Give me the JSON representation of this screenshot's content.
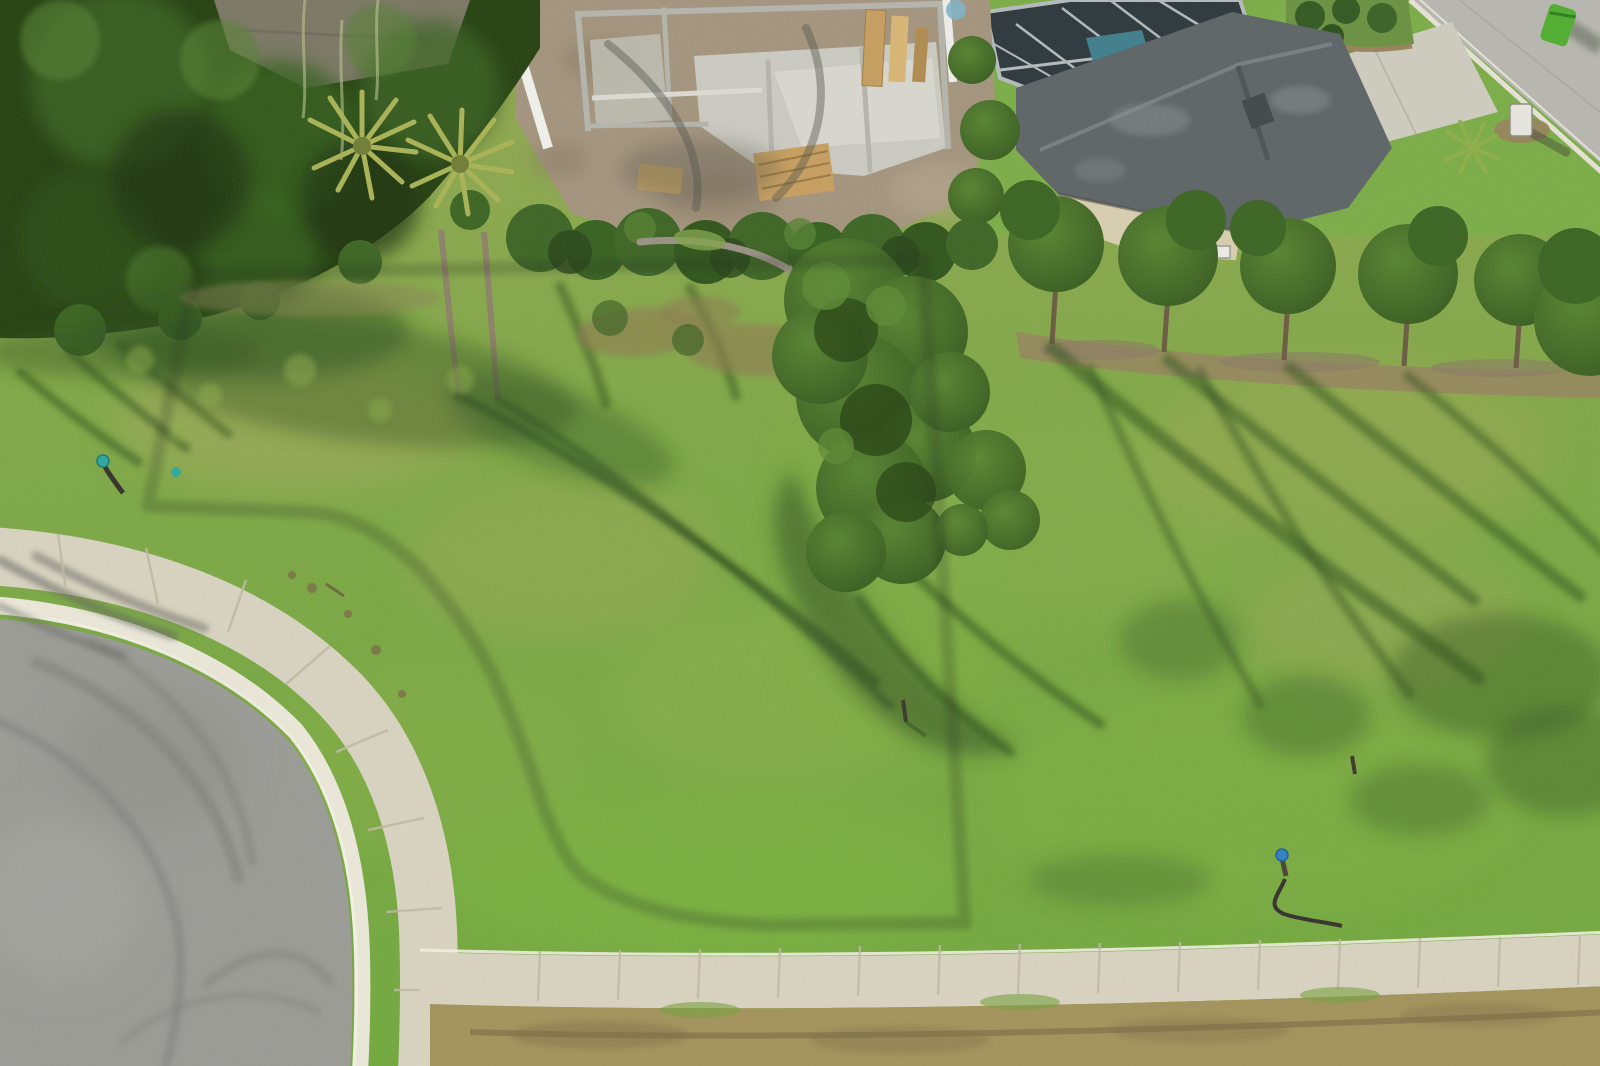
{
  "photo": {
    "kind": "aerial-drone-photo",
    "subject": "Vacant residential corner lot outlined in white, beside a cul-de-sac street with curved sidewalk; construction site and houses at top",
    "width": 1600,
    "height": 1066
  },
  "boundary": {
    "label": "property-boundary-outline",
    "color": "#ffffff",
    "stroke_width": 11
  },
  "colors": {
    "grass_top": "#93a751",
    "grass_mid": "#7da844",
    "grass_low": "#71a93d",
    "grass_bright": "#7eb43d",
    "grass_dry": "#a6a35e",
    "grass_pale": "#b1a465",
    "shadow": "#2e4f1b",
    "foliage_dark": "#24400f",
    "foliage_mid": "#3a6420",
    "foliage_light": "#548030",
    "palm_frond": "#a9b354",
    "palm_trunk": "#8d8168",
    "roof_hidden": "#857d6e",
    "dirt": "#a4947d",
    "dirt_dark": "#8a7a63",
    "slab": "#cbcbc2",
    "slab_bright": "#dadbd1",
    "block_wall": "#b4b5ac",
    "lumber": "#c79e5e",
    "lumber_light": "#d9b674",
    "fence_white": "#f2f2ec",
    "tarp_blue": "#7fb2c7",
    "enclosure": "#2c373b",
    "enclosure_frame": "#b3bbbd",
    "pool_water": "#3f7e8c",
    "roof_gray": "#5d6466",
    "roof_gray_light": "#7e8789",
    "wall_cream": "#d8cfb0",
    "window": "#ecebe4",
    "lawn": "#7bad46",
    "bed_mulch": "#97825a",
    "bush": "#32581f",
    "street": "#b8b7b0",
    "street_curb": "#e7e4d6",
    "driveway": "#cfccbf",
    "bin_green": "#4fae2e",
    "mailbox": "#e9e7e0",
    "asphalt": "#9b9b96",
    "tire_mark": "#7b7b76",
    "curb": "#ece9da",
    "curb_line": "#f5f2e6",
    "sidewalk": "#d9d4c0",
    "walk_joint": "#bfb9a3",
    "dry_strip": "#a3935a",
    "furrow": "#7d6c44",
    "marker_teal": "#2aa8a1",
    "marker_blue": "#2f7fc0",
    "hose": "#34302a",
    "branch": "#9a9184",
    "trunk": "#6b5a40",
    "brush_brown": "#8d7b4e"
  },
  "objects": {
    "dense_trees": "dense tree canopy upper left",
    "palm_trees": "two cabbage palms with hanging moss",
    "hidden_roof": "neighboring roof hidden in trees",
    "construction": "house under construction, concrete block walls and lumber",
    "white_fence": "white vinyl privacy fence",
    "pool_enclosure": "screened pool enclosure",
    "gray_roof_house": "single-story house with gray shingle roof",
    "street_corner": "street at top right with green trash bin and mailbox",
    "tree_row": "row of young oaks with dirt strip",
    "vacant_lot": "grassy vacant lot with long tree shadows",
    "oak_tree": "large live oak inside lot line",
    "cul_de_sac": "asphalt cul-de-sac with tire marks",
    "sidewalk_ring": "concrete sidewalk curving around cul-de-sac",
    "bottom_sidewalk": "straight sidewalk along bottom",
    "utility_markers": "teal and blue utility/irrigation markers"
  }
}
